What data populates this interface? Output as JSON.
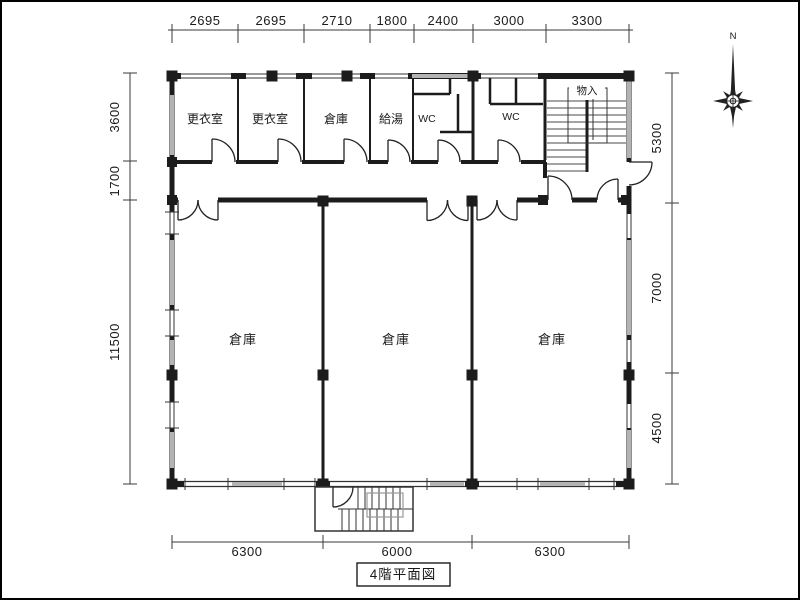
{
  "plan": {
    "title": "4階平面図",
    "compass_label": "N",
    "rooms": {
      "top_row": [
        "更衣室",
        "更衣室",
        "倉庫",
        "給湯",
        "WC",
        "WC"
      ],
      "stair_closet": "物入",
      "warehouses": [
        "倉庫",
        "倉庫",
        "倉庫"
      ]
    },
    "dimensions": {
      "top": [
        "2695",
        "2695",
        "2710",
        "1800",
        "2400",
        "3000",
        "3300"
      ],
      "left": [
        "3600",
        "1700",
        "11500"
      ],
      "right": [
        "5300",
        "7000",
        "4500"
      ],
      "bottom": [
        "6300",
        "6000",
        "6300"
      ]
    },
    "colors": {
      "ink": "#1c1c1c",
      "hatch": "#b3b3b3",
      "paper": "#ffffff"
    }
  }
}
